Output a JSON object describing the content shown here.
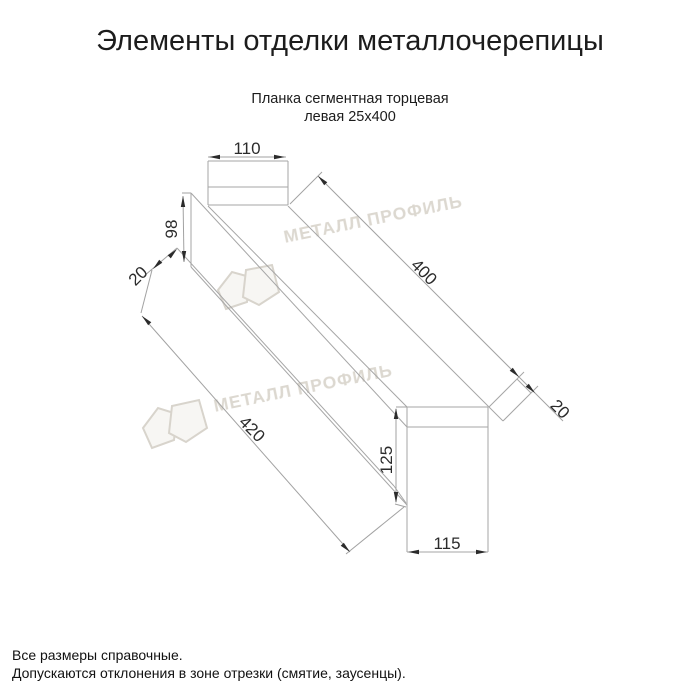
{
  "title": "Элементы отделки металлочерепицы",
  "subtitle": {
    "line1": "Планка сегментная торцевая",
    "line2": "левая 25х400"
  },
  "drawing": {
    "part_name": "Планка сегментная торцевая левая 25х400",
    "dims": {
      "top_width": "110",
      "left_height": "98",
      "left_flange": "20",
      "length_top": "400",
      "right_flange": "20",
      "length_bottom": "420",
      "right_height": "125",
      "right_width": "115"
    }
  },
  "watermark": {
    "text": "МЕТАЛЛ ПРОФИЛЬ",
    "color": "#dcd8d0"
  },
  "footer": {
    "line1": "Все размеры справочные.",
    "line2": "Допускаются отклонения в зоне отрезки (смятие, заусенцы)."
  },
  "colors": {
    "background": "#ffffff",
    "profile_lines": "#a6a6a6",
    "dimension_text": "#2b2b2b",
    "title_text": "#1c1c1c"
  }
}
